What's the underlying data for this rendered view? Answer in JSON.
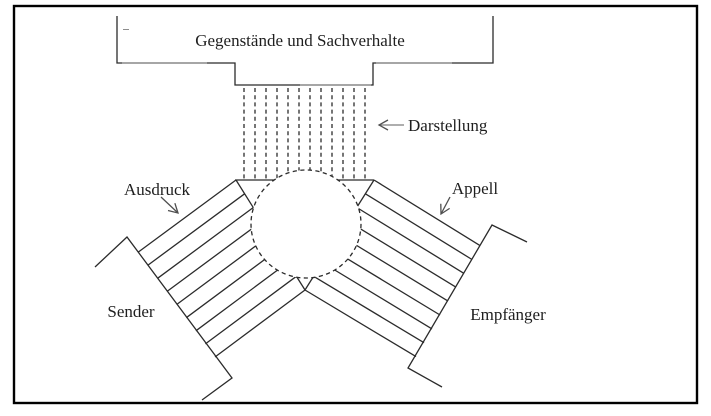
{
  "title_box": {
    "label": "Gegenstände und Sachverhalte"
  },
  "annotations": {
    "darstellung": "Darstellung",
    "ausdruck": "Ausdruck",
    "appell": "Appell"
  },
  "actors": {
    "sender": "Sender",
    "empfaenger": "Empfänger"
  },
  "colors": {
    "line": "#2b2b2b",
    "text": "#1f1f1f",
    "accent_gray": "#9e9e9e",
    "background": "#ffffff"
  }
}
